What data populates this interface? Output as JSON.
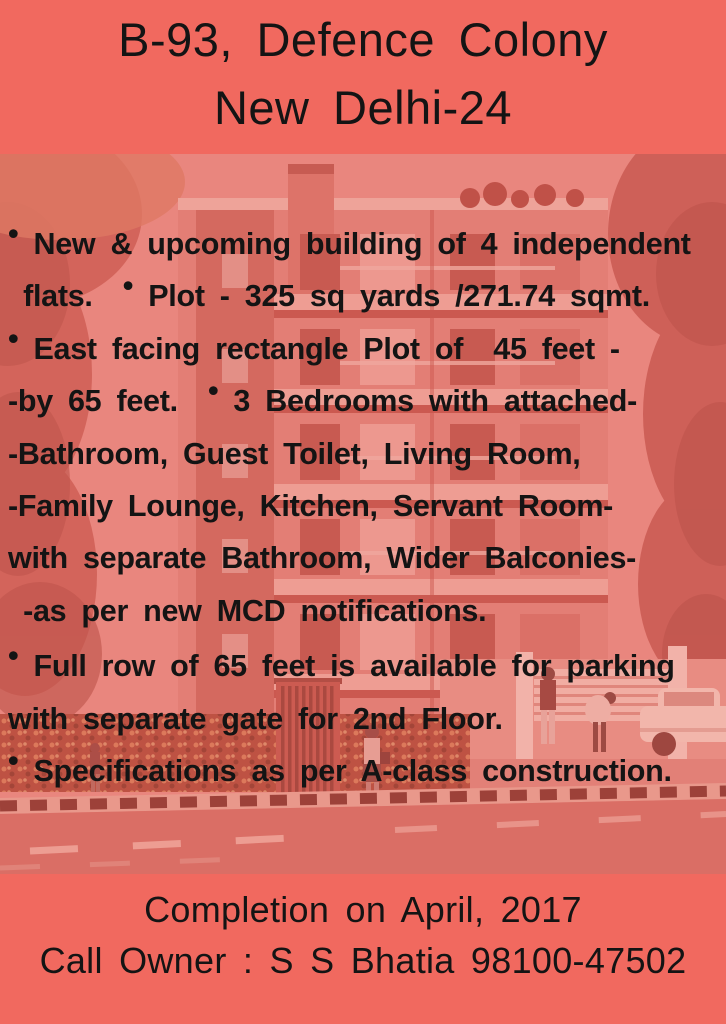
{
  "poster": {
    "header": {
      "line1": "B-93, Defence Colony",
      "line2": "New Delhi-24"
    },
    "body": {
      "lines": [
        "• New & upcoming building of 4 independent",
        " flats.  • Plot - 325 sq yards /271.74 sqmt.",
        "• East facing rectangle Plot of  45 feet -",
        "-by 65 feet.  • 3 Bedrooms with attached-",
        "-Bathroom, Guest Toilet, Living Room,",
        "-Family Lounge, Kitchen, Servant Room-",
        "with separate Bathroom, Wider Balconies-",
        " -as per new MCD notifications.",
        "• Full row of 65 feet is available for parking",
        "with separate gate for 2nd Floor.",
        "• Specifications as per A-class construction."
      ]
    },
    "footer": {
      "line1": "Completion on April, 2017",
      "line2": "Call Owner : S S Bhatia 98100-47502"
    },
    "colors": {
      "band_coral": "#F1695F",
      "photo_tint_pink": "#E98D86",
      "text_black": "#141414"
    }
  }
}
